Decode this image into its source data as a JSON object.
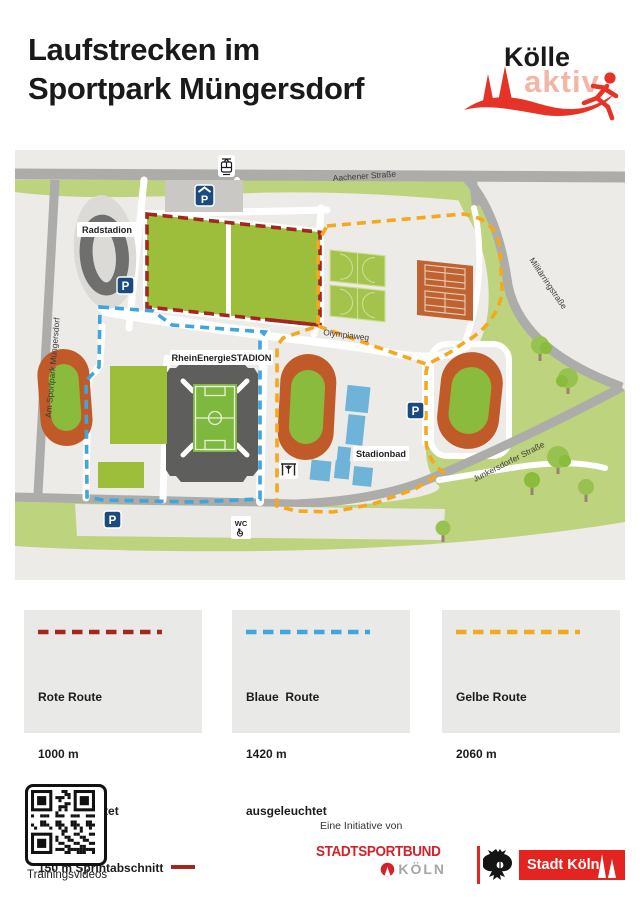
{
  "header": {
    "title_line1": "Laufstrecken im",
    "title_line2": "Sportpark Müngersdorf"
  },
  "brand": {
    "word_top": "Kölle",
    "word_bottom": "aktiv"
  },
  "map": {
    "streets": {
      "aachener": "Aachener Straße",
      "militaerring": "Militärringstraße",
      "junkersdorfer": "Junkersdorfer Straße",
      "am_sportpark": "Am Sportpark Müngersdorf",
      "olympiaweg": "Olympiaweg"
    },
    "places": {
      "radstadion": "Radstadion",
      "stadion": "RheinEnergieSTADION",
      "stadionbad": "Stadionbad"
    },
    "icons": {
      "parking": "P",
      "wc": "WC"
    }
  },
  "legend": {
    "cards": [
      {
        "route": "Rote Route",
        "distance": "1000 m",
        "note": "ausgeleuchtet",
        "extra": "150 m Sprintabschnitt"
      },
      {
        "route": "Blaue  Route",
        "distance": "1420 m",
        "note": "ausgeleuchtet",
        "extra": ""
      },
      {
        "route": "Gelbe Route",
        "distance": "2060 m",
        "note": "",
        "extra": ""
      }
    ]
  },
  "footer": {
    "qr_caption": "Trainingsvideos",
    "initiative_label": "Eine Initiative von",
    "stadtsportbund_line1": "STADTSPORTBUND",
    "stadtsportbund_line2": "KÖLN",
    "stadt_koeln": "Stadt Köln"
  },
  "colors": {
    "route-red": "#A52521",
    "route-blue": "#3FA5DB",
    "route-yellow": "#F5A81E",
    "brand-red": "#E63327",
    "brand-salmon": "#F4B5A4",
    "ssb-red": "#D2232A",
    "stadt-red": "#E32421",
    "park-green": "#BDD37D",
    "field-green": "#9CBE3B",
    "track-orange": "#C05A28",
    "pool-blue": "#6FB3D8",
    "road-gray": "#ACACAB",
    "map-bg": "#ECEBE8"
  }
}
